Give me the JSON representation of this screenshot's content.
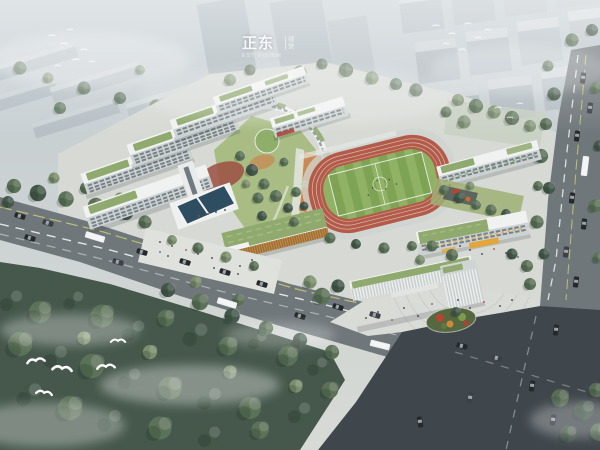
{
  "meta": {
    "type": "aerial-architectural-rendering",
    "subject": "school campus master plan bird's-eye view"
  },
  "watermark": {
    "primary": "正东",
    "secondary_top": "视",
    "secondary_bottom": "觉",
    "caption": "EST VISION"
  },
  "palette": {
    "sky": "#c6ced3",
    "sky-low": "#d8dbd6",
    "city": "#b6c0c5",
    "city-top": "#d1d8da",
    "ground": "#d6d9d4",
    "road": "#70777b",
    "asphalt": "#40474c",
    "lane-white": "#eef1f2",
    "lane-yellow": "#c9cc74",
    "building-white": "#f0f2f1",
    "facade": "#ccd2d2",
    "window": "#535e66",
    "roof-green": "#8fa96e",
    "roof-green-light": "#a9c084",
    "lawn": "#a3b87b",
    "track-red": "#b35a48",
    "field-green": "#7fa355",
    "field-green-2": "#8fb264",
    "court-orange": "#c98a52",
    "court-orange-2": "#cf8044",
    "pool-blue": "#2e4d60",
    "plaza": "#d9dbd7",
    "plaza-light": "#dfe1dd",
    "tree-dark": "#44584a",
    "tree-mid": "#5c7258",
    "tree-light": "#7b8f6d",
    "forest": "#46584c",
    "car-dark": "#26292c",
    "car-gray": "#3c4046",
    "car-white": "#eef0f1",
    "accent-red": "#b8432f",
    "accent-yellow": "#e2a63d",
    "island-green": "#55683f"
  }
}
